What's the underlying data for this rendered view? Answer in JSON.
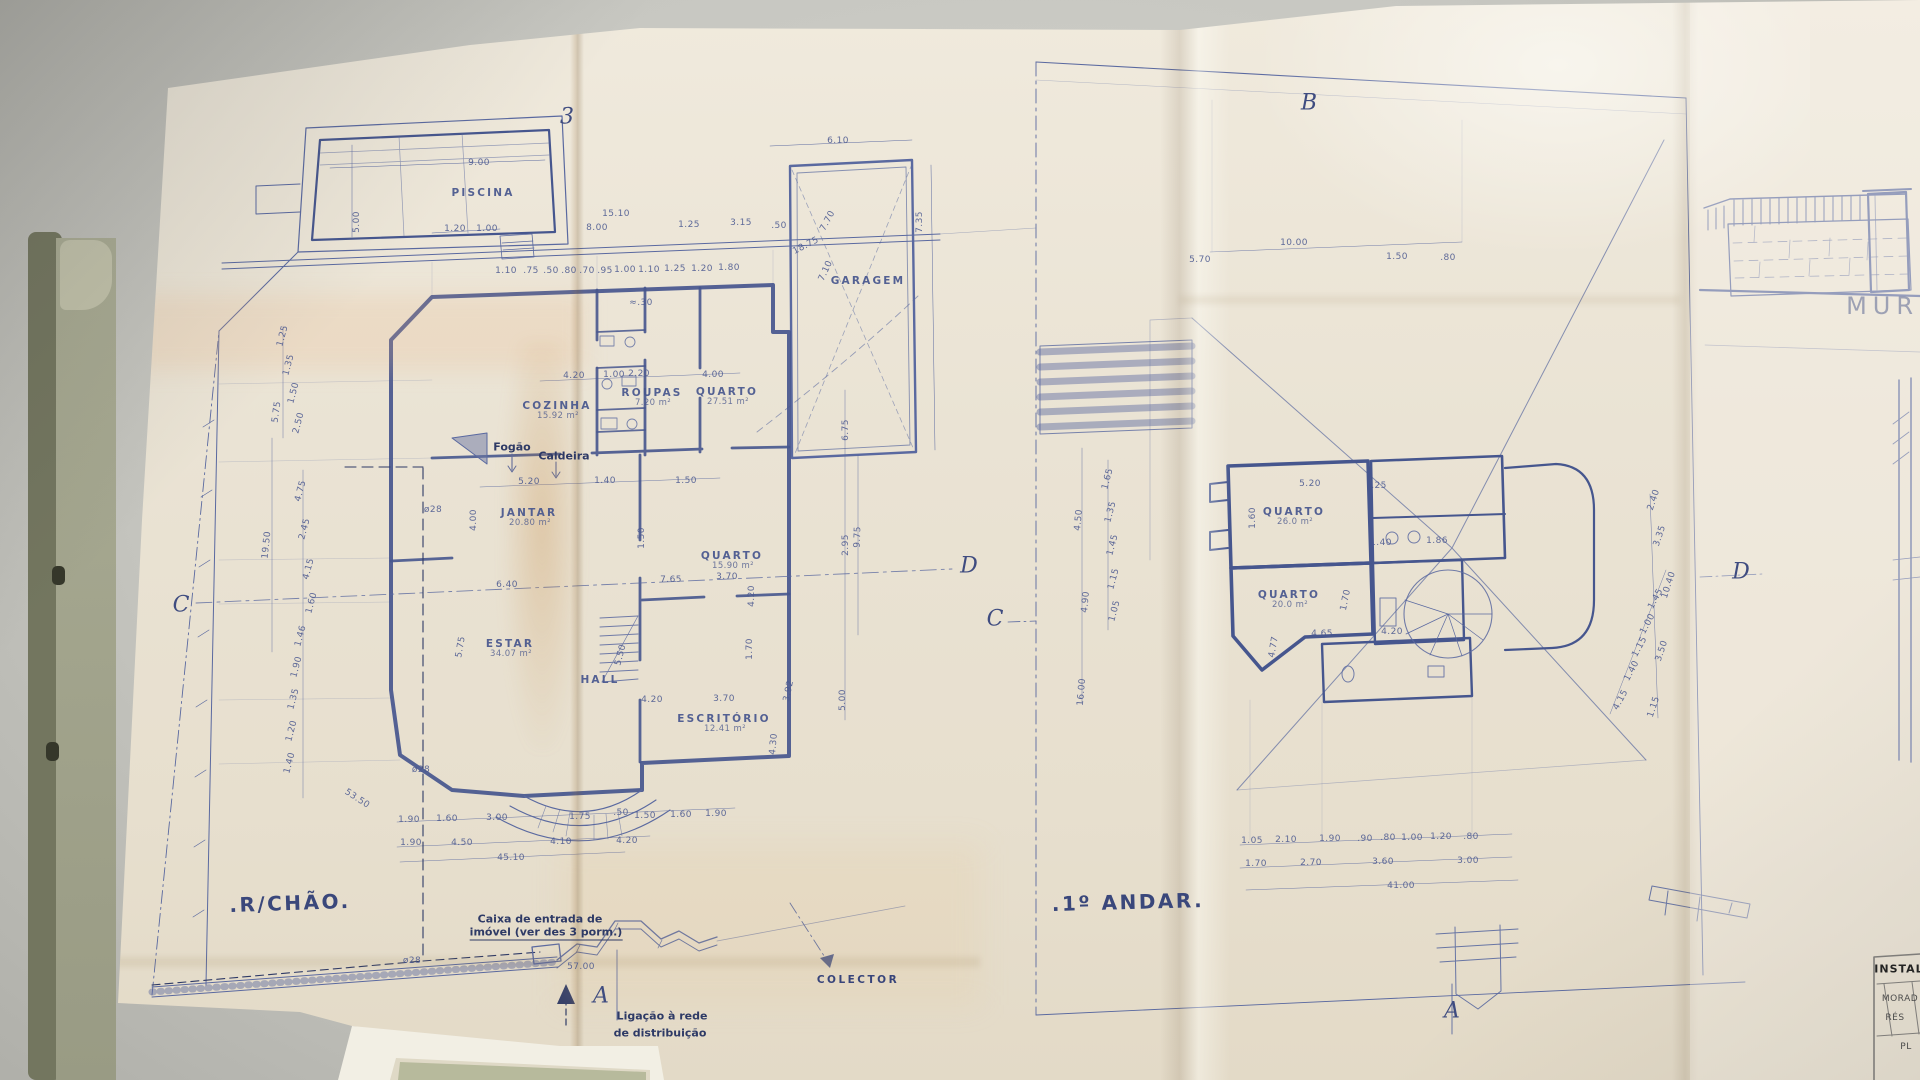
{
  "colors": {
    "ink": "#5a69a0",
    "wall": "#46568e",
    "paper": "#eae3d4",
    "desk": "#c7c7c1",
    "folder": "#9b9d86"
  },
  "left_plan": {
    "floor_label": ".R/CHÃO.",
    "markers": [
      {
        "label": "3"
      },
      {
        "label": "C"
      },
      {
        "label": "D"
      },
      {
        "label": "A"
      }
    ],
    "rooms": [
      {
        "name": "PISCINA",
        "x": 483,
        "y": 193
      },
      {
        "name": "GARAGEM",
        "x": 868,
        "y": 281
      },
      {
        "name": "COZINHA",
        "area": "15.92 m²",
        "x": 557,
        "y": 406
      },
      {
        "name": "ROUPAS",
        "area": "7.20 m²",
        "x": 652,
        "y": 393
      },
      {
        "name": "QUARTO",
        "area": "27.51 m²",
        "x": 727,
        "y": 392
      },
      {
        "name": "JANTAR",
        "area": "20.80 m²",
        "x": 529,
        "y": 513
      },
      {
        "name": "ESTAR",
        "area": "34.07 m²",
        "x": 510,
        "y": 644
      },
      {
        "name": "HALL",
        "x": 600,
        "y": 680
      },
      {
        "name": "QUARTO",
        "area": "15.90 m²",
        "x": 732,
        "y": 556
      },
      {
        "name": "ESCRITÓRIO",
        "area": "12.41 m²",
        "x": 724,
        "y": 719
      }
    ],
    "notes": [
      {
        "t": "Fogão",
        "x": 512,
        "y": 447
      },
      {
        "t": "Caldeira",
        "x": 564,
        "y": 456
      },
      {
        "t": "Caixa de entrada de",
        "x": 540,
        "y": 919
      },
      {
        "t": "imóvel (ver des 3 porm.)",
        "x": 546,
        "y": 933,
        "u": 1
      },
      {
        "t": "Ligação à rede",
        "x": 662,
        "y": 1016
      },
      {
        "t": "de distribuição",
        "x": 660,
        "y": 1033
      },
      {
        "t": "COLECTOR",
        "x": 858,
        "y": 980,
        "c": "notecaps"
      },
      {
        "t": "ø28",
        "x": 433,
        "y": 510,
        "c": "dim"
      },
      {
        "t": "ø28",
        "x": 421,
        "y": 770,
        "c": "dim"
      },
      {
        "t": "ø28",
        "x": 412,
        "y": 961,
        "c": "dim"
      }
    ],
    "dimensions": [
      {
        "t": "9.00",
        "x": 479,
        "y": 163
      },
      {
        "t": "5.00",
        "x": 357,
        "y": 222,
        "r": -90
      },
      {
        "t": "1.20",
        "x": 455,
        "y": 229
      },
      {
        "t": "1.00",
        "x": 487,
        "y": 229
      },
      {
        "t": "15.10",
        "x": 616,
        "y": 214
      },
      {
        "t": "8.00",
        "x": 597,
        "y": 228
      },
      {
        "t": "1.25",
        "x": 689,
        "y": 225
      },
      {
        "t": "3.15",
        "x": 741,
        "y": 223
      },
      {
        "t": ".50",
        "x": 779,
        "y": 226
      },
      {
        "t": "1.10",
        "x": 506,
        "y": 271
      },
      {
        "t": ".75",
        "x": 531,
        "y": 271
      },
      {
        "t": ".50",
        "x": 551,
        "y": 271
      },
      {
        "t": ".80",
        "x": 569,
        "y": 271
      },
      {
        "t": ".70",
        "x": 587,
        "y": 271
      },
      {
        "t": ".95",
        "x": 605,
        "y": 271
      },
      {
        "t": "1.00",
        "x": 625,
        "y": 270
      },
      {
        "t": "1.10",
        "x": 649,
        "y": 270
      },
      {
        "t": "1.25",
        "x": 675,
        "y": 269
      },
      {
        "t": "1.20",
        "x": 702,
        "y": 269
      },
      {
        "t": "1.80",
        "x": 729,
        "y": 268
      },
      {
        "t": "6.10",
        "x": 838,
        "y": 141
      },
      {
        "t": "7.35",
        "x": 920,
        "y": 222,
        "r": -90
      },
      {
        "t": "7.70",
        "x": 828,
        "y": 221,
        "r": -62
      },
      {
        "t": "18.75",
        "x": 806,
        "y": 246,
        "r": -27
      },
      {
        "t": "7.10",
        "x": 826,
        "y": 271,
        "r": -65
      },
      {
        "t": "≈.30",
        "x": 641,
        "y": 303
      },
      {
        "t": "4.20",
        "x": 574,
        "y": 376
      },
      {
        "t": "1.00",
        "x": 614,
        "y": 375
      },
      {
        "t": "2.20",
        "x": 639,
        "y": 374
      },
      {
        "t": "4.00",
        "x": 713,
        "y": 375
      },
      {
        "t": "5.20",
        "x": 529,
        "y": 482
      },
      {
        "t": "1.40",
        "x": 605,
        "y": 481
      },
      {
        "t": "1.50",
        "x": 686,
        "y": 481
      },
      {
        "t": "6.40",
        "x": 507,
        "y": 585
      },
      {
        "t": "4.00",
        "x": 474,
        "y": 520,
        "r": -90
      },
      {
        "t": "5.75",
        "x": 461,
        "y": 647,
        "r": -80
      },
      {
        "t": "5.50",
        "x": 621,
        "y": 655,
        "r": -75
      },
      {
        "t": "1.50",
        "x": 642,
        "y": 538,
        "r": -90
      },
      {
        "t": "7.65",
        "x": 671,
        "y": 580
      },
      {
        "t": "3.70",
        "x": 727,
        "y": 577
      },
      {
        "t": "4.20",
        "x": 752,
        "y": 596,
        "r": -90
      },
      {
        "t": "1.70",
        "x": 750,
        "y": 649,
        "r": -90
      },
      {
        "t": "4.20",
        "x": 652,
        "y": 700
      },
      {
        "t": "3.70",
        "x": 724,
        "y": 699
      },
      {
        "t": "4.30",
        "x": 774,
        "y": 744,
        "r": -85
      },
      {
        "t": "3.92",
        "x": 789,
        "y": 691,
        "r": -78
      },
      {
        "t": "1.25",
        "x": 283,
        "y": 336,
        "r": -75
      },
      {
        "t": "1.35",
        "x": 289,
        "y": 365,
        "r": -75
      },
      {
        "t": "1.50",
        "x": 294,
        "y": 393,
        "r": -75
      },
      {
        "t": "2.50",
        "x": 299,
        "y": 423,
        "r": -75
      },
      {
        "t": "5.75",
        "x": 277,
        "y": 412,
        "r": -82
      },
      {
        "t": "19.50",
        "x": 267,
        "y": 545,
        "r": -84
      },
      {
        "t": "4.75",
        "x": 301,
        "y": 491,
        "r": -75
      },
      {
        "t": "2.45",
        "x": 305,
        "y": 529,
        "r": -75
      },
      {
        "t": "4.15",
        "x": 309,
        "y": 569,
        "r": -75
      },
      {
        "t": "1.60",
        "x": 312,
        "y": 603,
        "r": -75
      },
      {
        "t": "1.46",
        "x": 301,
        "y": 636,
        "r": -75
      },
      {
        "t": "1.90",
        "x": 297,
        "y": 667,
        "r": -75
      },
      {
        "t": "1.35",
        "x": 294,
        "y": 699,
        "r": -75
      },
      {
        "t": "1.20",
        "x": 292,
        "y": 731,
        "r": -75
      },
      {
        "t": "1.40",
        "x": 290,
        "y": 763,
        "r": -75
      },
      {
        "t": "53.50",
        "x": 357,
        "y": 799,
        "r": 33
      },
      {
        "t": "6.75",
        "x": 846,
        "y": 430,
        "r": -90
      },
      {
        "t": "2.95",
        "x": 846,
        "y": 545,
        "r": -90
      },
      {
        "t": "5.00",
        "x": 843,
        "y": 700,
        "r": -90
      },
      {
        "t": "9.75",
        "x": 858,
        "y": 537,
        "r": -88
      },
      {
        "t": "1.90",
        "x": 409,
        "y": 820
      },
      {
        "t": "1.60",
        "x": 447,
        "y": 819
      },
      {
        "t": "3.00",
        "x": 497,
        "y": 818
      },
      {
        "t": "1.75",
        "x": 580,
        "y": 817
      },
      {
        "t": ".50",
        "x": 621,
        "y": 813
      },
      {
        "t": "1.50",
        "x": 645,
        "y": 816
      },
      {
        "t": "1.60",
        "x": 681,
        "y": 815
      },
      {
        "t": "1.90",
        "x": 716,
        "y": 814
      },
      {
        "t": "1.90",
        "x": 411,
        "y": 843
      },
      {
        "t": "4.50",
        "x": 462,
        "y": 843
      },
      {
        "t": "4.10",
        "x": 561,
        "y": 842
      },
      {
        "t": "4.20",
        "x": 627,
        "y": 841
      },
      {
        "t": "45.10",
        "x": 511,
        "y": 858
      },
      {
        "t": "57.00",
        "x": 581,
        "y": 967
      }
    ]
  },
  "right_plan": {
    "floor_label": ".1º ANDAR.",
    "markers": [
      {
        "label": "B"
      },
      {
        "label": "C"
      },
      {
        "label": "D"
      },
      {
        "label": "A"
      }
    ],
    "rooms": [
      {
        "name": "QUARTO",
        "area": "26.0 m²",
        "x": 1294,
        "y": 512
      },
      {
        "name": "QUARTO",
        "area": "20.0 m²",
        "x": 1289,
        "y": 595
      }
    ],
    "notes": [],
    "dimensions": [
      {
        "t": "5.70",
        "x": 1200,
        "y": 260
      },
      {
        "t": "10.00",
        "x": 1294,
        "y": 243
      },
      {
        "t": "1.50",
        "x": 1397,
        "y": 257
      },
      {
        "t": ".80",
        "x": 1448,
        "y": 258
      },
      {
        "t": "5.20",
        "x": 1310,
        "y": 484
      },
      {
        "t": ".25",
        "x": 1379,
        "y": 486
      },
      {
        "t": "1.60",
        "x": 1253,
        "y": 518,
        "r": -90
      },
      {
        "t": "1.40",
        "x": 1381,
        "y": 543
      },
      {
        "t": "1.86",
        "x": 1437,
        "y": 541
      },
      {
        "t": "1.70",
        "x": 1346,
        "y": 600,
        "r": -78
      },
      {
        "t": "4.65",
        "x": 1322,
        "y": 634
      },
      {
        "t": "4.20",
        "x": 1392,
        "y": 632
      },
      {
        "t": "4.77",
        "x": 1274,
        "y": 647,
        "r": -80
      },
      {
        "t": "4.50",
        "x": 1079,
        "y": 520,
        "r": -85
      },
      {
        "t": "4.90",
        "x": 1086,
        "y": 602,
        "r": -85
      },
      {
        "t": "16.00",
        "x": 1082,
        "y": 692,
        "r": -85
      },
      {
        "t": "1.65",
        "x": 1108,
        "y": 479,
        "r": -75
      },
      {
        "t": "1.35",
        "x": 1111,
        "y": 512,
        "r": -75
      },
      {
        "t": "1.45",
        "x": 1113,
        "y": 545,
        "r": -75
      },
      {
        "t": "1.15",
        "x": 1114,
        "y": 579,
        "r": -75
      },
      {
        "t": "1.05",
        "x": 1115,
        "y": 611,
        "r": -75
      },
      {
        "t": "4.15",
        "x": 1621,
        "y": 700,
        "r": -62
      },
      {
        "t": "1.40",
        "x": 1632,
        "y": 671,
        "r": -62
      },
      {
        "t": "1.15",
        "x": 1640,
        "y": 647,
        "r": -62
      },
      {
        "t": "1.00",
        "x": 1648,
        "y": 624,
        "r": -62
      },
      {
        "t": "1.45",
        "x": 1656,
        "y": 599,
        "r": -62
      },
      {
        "t": "2.40",
        "x": 1654,
        "y": 500,
        "r": -72
      },
      {
        "t": "3.35",
        "x": 1660,
        "y": 536,
        "r": -72
      },
      {
        "t": "10.40",
        "x": 1669,
        "y": 585,
        "r": -72
      },
      {
        "t": "3.50",
        "x": 1662,
        "y": 651,
        "r": -72
      },
      {
        "t": "1.15",
        "x": 1654,
        "y": 707,
        "r": -72
      },
      {
        "t": "1.05",
        "x": 1252,
        "y": 841
      },
      {
        "t": "2.10",
        "x": 1286,
        "y": 840
      },
      {
        "t": "1.90",
        "x": 1330,
        "y": 839
      },
      {
        "t": ".90",
        "x": 1365,
        "y": 839
      },
      {
        "t": ".80",
        "x": 1388,
        "y": 838
      },
      {
        "t": "1.00",
        "x": 1412,
        "y": 838
      },
      {
        "t": "1.20",
        "x": 1441,
        "y": 837
      },
      {
        "t": ".80",
        "x": 1471,
        "y": 837
      },
      {
        "t": "1.70",
        "x": 1256,
        "y": 864
      },
      {
        "t": "2.70",
        "x": 1311,
        "y": 863
      },
      {
        "t": "3.60",
        "x": 1383,
        "y": 862
      },
      {
        "t": "3.00",
        "x": 1468,
        "y": 861
      },
      {
        "t": "41.00",
        "x": 1401,
        "y": 886
      }
    ]
  },
  "elevation": {
    "label": "MURO"
  },
  "title_block": {
    "lines": [
      {
        "t": "INSTAL"
      },
      {
        "t": "MORAD"
      },
      {
        "t": "RÉS"
      },
      {
        "t": "PL"
      }
    ]
  }
}
